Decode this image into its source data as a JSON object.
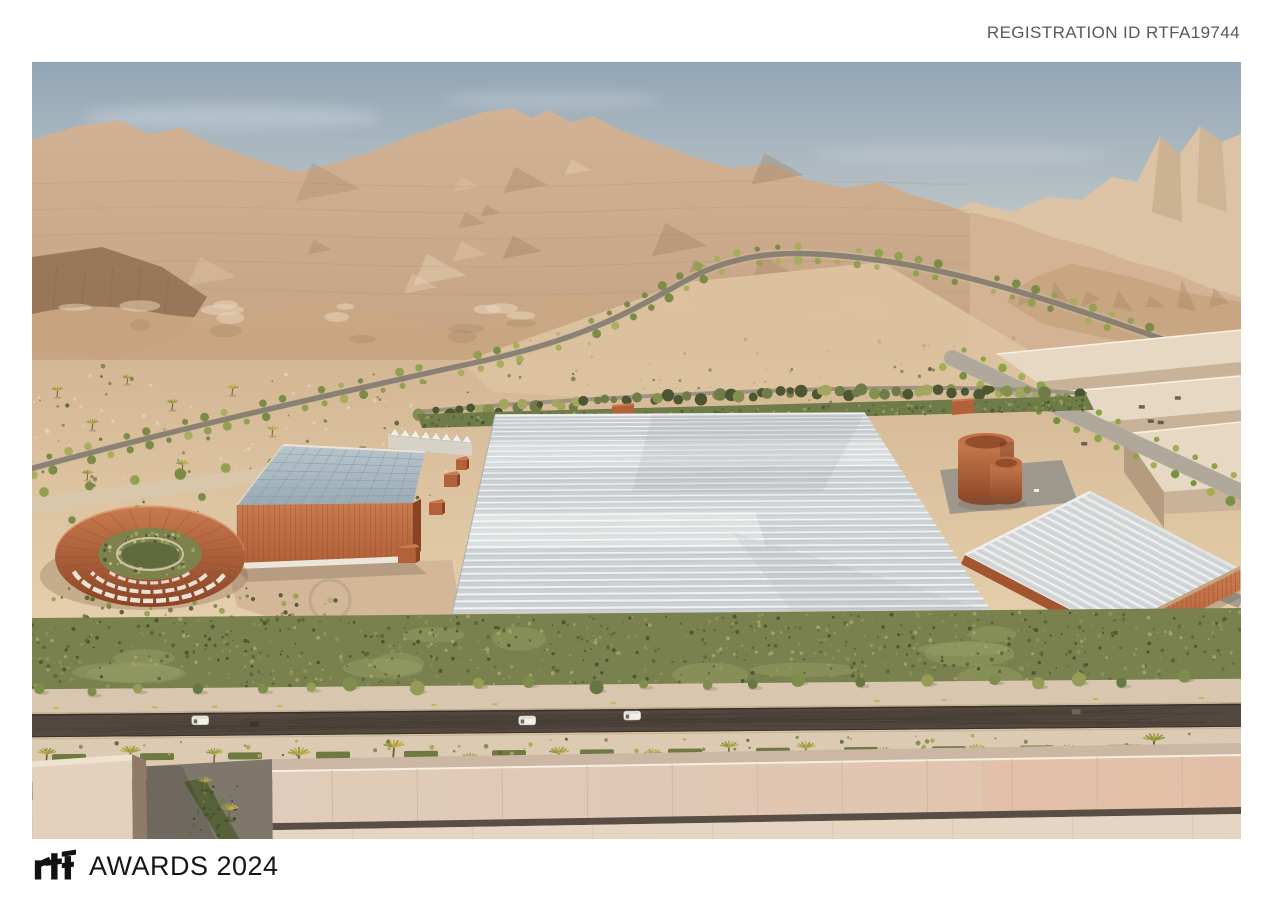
{
  "header": {
    "registration_id": "REGISTRATION ID RTFA19744"
  },
  "footer": {
    "logo": "rtf",
    "awards_title": "AWARDS 2024"
  },
  "palette": {
    "text_gray": "#58595b",
    "text_black": "#161616",
    "sky_top": "#92a6b6",
    "sky_mid": "#bfc6c7",
    "sky_horizon": "#e7e0d3",
    "rock_far": "#ddc3a6",
    "rock_light": "#d2b294",
    "rock_base": "#c3a183",
    "rock_mid": "#c9a682",
    "rock_shadow": "#9c7a5a",
    "rock_sun": "#ecd7bd",
    "rock_deep": "#8c6a4e",
    "rock_right": "#d3b394",
    "sand_top": "#d4b794",
    "sand_bottom": "#e7d1ae",
    "field": "#ddc2a0",
    "road_midground": "#837a6f",
    "road_gray": "#b0a89a",
    "veg_dark": "#4c5731",
    "veg_mid": "#6f7b48",
    "veg_light": "#94a055",
    "veg_yellow": "#b3ab5e",
    "veg_bright": "#8ca448",
    "hedge_base": "#79814e",
    "corten": "#b2613a",
    "corten_light": "#c97a4e",
    "corten_dark": "#8a4526",
    "corten_deep": "#5e2f1a",
    "glass_hi": "#b9c5cc",
    "glass_lo": "#9aabb5",
    "glass_grid": "#8798a3",
    "gh_roof": "#cbd0d2",
    "gh_stripe": "#f4f6f6",
    "gh_stripe_dark": "#b7bdc0",
    "gh_tan": "#c4a47c",
    "warehouse_top": "#e6d8c2",
    "warehouse_front": "#c8b298",
    "warehouse_side": "#b59c81",
    "plaza": "#d2b597",
    "pave_light": "#d9c7ab",
    "fg_sidewalk": "#d8c6ae",
    "fg_sidewalk2": "#ddcab2",
    "fg_road": "#53483f",
    "fg_shrub": "#474f2c",
    "bld_front": "#e3d1be",
    "bld_top": "#f0e2d0",
    "bld_side": "#8f7b67",
    "bld_court": "#7f776c",
    "bld_fascia": "#ccb7a5",
    "bld_roof1": "#e0ccba",
    "bld_roof2": "#e2c2ab",
    "bld_groove": "#584e45",
    "bld_lower": "#e7d5c3",
    "white_warm": "#f2f0ea",
    "shadow": "#6b5a4a"
  }
}
